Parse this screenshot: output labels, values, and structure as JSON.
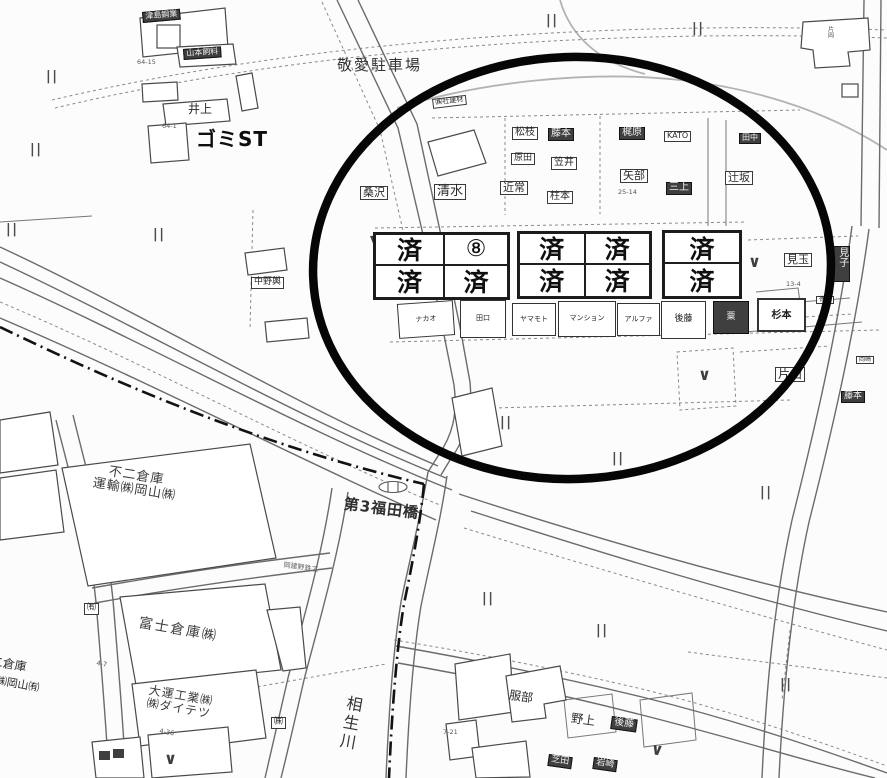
{
  "colors": {
    "annotation_circle": "#060606",
    "dark_box_bg": "#3f3f3f",
    "map_background": "#fcfcfc"
  },
  "symbols": {
    "parallel_mark": "||",
    "check_mark": "∨",
    "grid_corner_wedge": "▼"
  },
  "grid": {
    "row1": [
      "済",
      "⑧",
      "済",
      "済",
      "済"
    ],
    "row2": [
      "済",
      "済",
      "済",
      "済",
      "済"
    ]
  },
  "labels": {
    "keiai": "敬愛駐車場",
    "gomi": "ゴミST",
    "inoue": "井上",
    "tsushima": "津島鋼業",
    "yamamoto_feed": "山本飼料",
    "shakenzai": "㈱社建材",
    "kuwasawa": "桑沢",
    "shimizu": "清水",
    "chikatsune": "近常",
    "matsueda": "松枝",
    "fujimoto": "藤本",
    "harada": "原田",
    "kasai": "笠井",
    "hashiramoto": "柱本",
    "kajiwara": "梶原",
    "kato": "KATO",
    "yabe": "矢部",
    "mikami": "三上",
    "tsujisaka": "辻坂",
    "tanaka": "田中",
    "nakano": "中野輿",
    "mitama": "見玉",
    "miko": "見子",
    "tokunaga": "徳永",
    "katayama": "片山",
    "fujimoto2": "藤本",
    "okazaki": "岡崎",
    "kataoka": "片岡",
    "fuji2": "不二倉庫\n運輸㈱岡山㈱",
    "fujisoko": "富士倉庫㈱",
    "daiun": "大運工業㈱\n㈱ダイテツ",
    "bridge": "第3福田橋",
    "tateno": "岡建野鉄工",
    "aioi": "相生川",
    "cut1": "二倉庫",
    "cut2": "輸㈱岡山㈲",
    "hattori": "服部",
    "nogami": "野上",
    "goto2": "後藤",
    "shibata": "芝田",
    "iwasaki": "岩崎",
    "yuugen": "㈲",
    "kabu": "㈱"
  },
  "shops": {
    "nakao": "ナカオ",
    "taguchi": "田口",
    "yamamoto2": "ヤマモト",
    "mansion": "マンション",
    "alpha": "アルファ",
    "goto1": "後藤",
    "awa": "粟",
    "sugimoto": "杉本"
  },
  "lots": {
    "a": "64-15",
    "b": "64-1",
    "c": "25-14",
    "d": "13-4",
    "e": "4-7",
    "f": "4-36",
    "g": "7-21"
  }
}
